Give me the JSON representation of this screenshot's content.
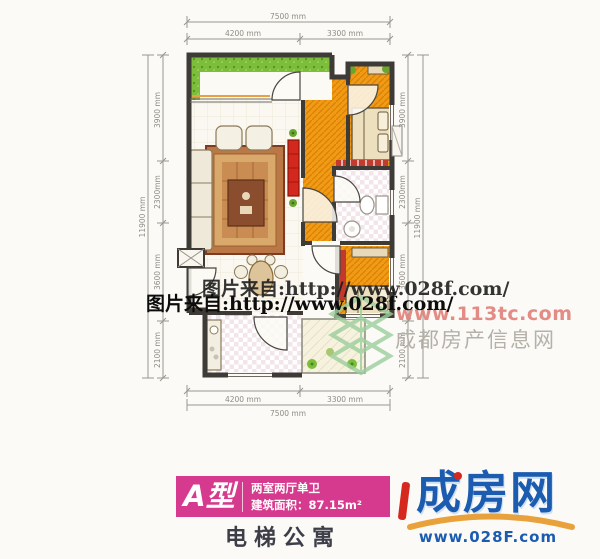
{
  "watermark": {
    "source_text": "图片来自:http://www.028f.com/",
    "portal_url": "www.113tc.com",
    "portal_name": "成都房产信息网"
  },
  "dimensions": {
    "total_width": "7500 mm",
    "width_segments": [
      "4200 mm",
      "3300 mm"
    ],
    "total_height": "11900 mm",
    "height_segments": [
      "3900 mm",
      "2300mm",
      "3600 mm",
      "2100 mm"
    ]
  },
  "card": {
    "type_label": "A型",
    "layout": "两室两厅单卫",
    "area": "建筑面积：87.15m²",
    "building_type": "电梯公寓"
  },
  "brand": {
    "name": "成房网",
    "url": "www.028F.com"
  },
  "colors": {
    "accent_pink": "#d63a8e",
    "room_orange": "#f09a15",
    "balcony_green": "#7cbe3c",
    "wall_dark": "#3e3a35",
    "brand_blue": "#1b5cb1",
    "brand_orange": "#e9a23b",
    "watermark_red": "#e2837d",
    "watermark_gray": "#b5b1a9"
  }
}
